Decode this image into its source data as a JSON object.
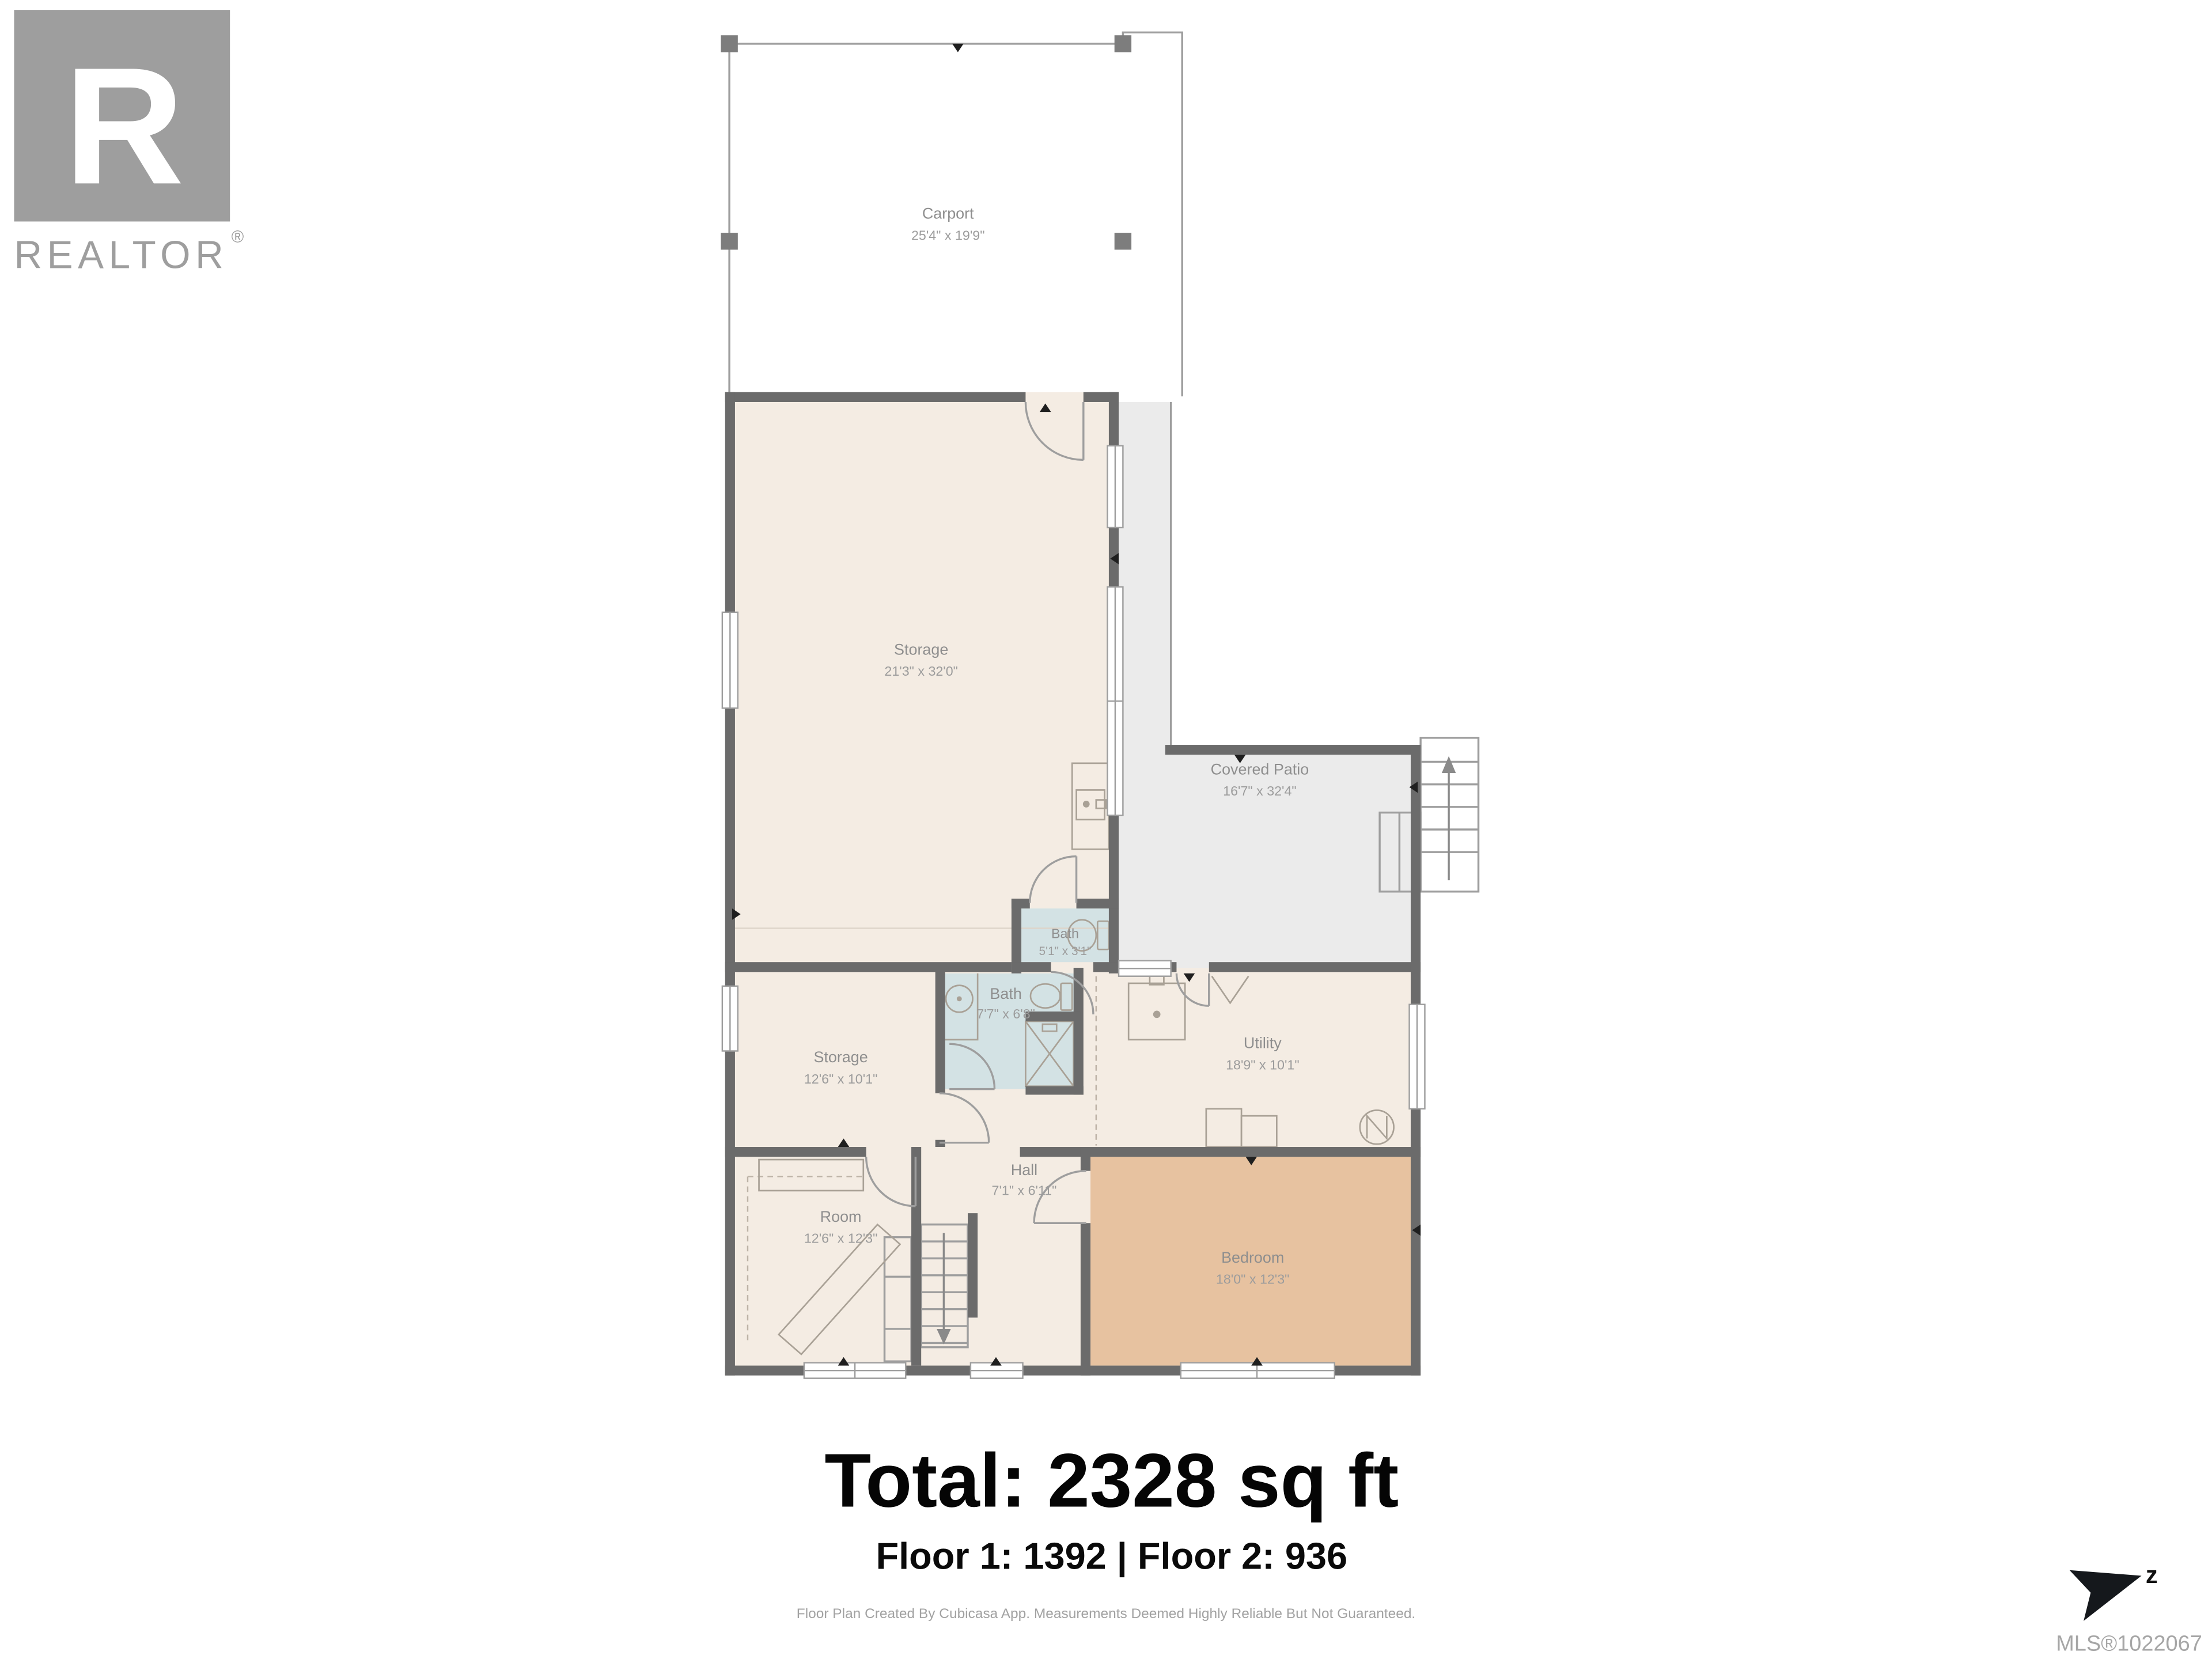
{
  "branding": {
    "logo_letter": "R",
    "logo_text": "REALTOR",
    "registered_mark": "®"
  },
  "rooms": [
    {
      "name": "Carport",
      "dims": "25'4\" x 19'9\""
    },
    {
      "name": "Storage",
      "dims": "21'3\" x 32'0\""
    },
    {
      "name": "Covered Patio",
      "dims": "16'7\" x 32'4\""
    },
    {
      "name": "Bath",
      "dims": "5'1\" x 3'1\""
    },
    {
      "name": "Bath",
      "dims": "7'7\" x 6'8\""
    },
    {
      "name": "Storage",
      "dims": "12'6\" x 10'1\""
    },
    {
      "name": "Utility",
      "dims": "18'9\" x 10'1\""
    },
    {
      "name": "Hall",
      "dims": "7'1\" x 6'11\""
    },
    {
      "name": "Room",
      "dims": "12'6\" x 12'3\""
    },
    {
      "name": "Bedroom",
      "dims": "18'0\" x 12'3\""
    }
  ],
  "summary": {
    "total": "Total: 2328 sq ft",
    "floors": "Floor 1: 1392 | Floor 2: 936"
  },
  "footer": {
    "disclaimer": "Floor Plan Created By Cubicasa App. Measurements Deemed Highly Reliable But Not Guaranteed.",
    "mls": "MLS®1022067"
  },
  "compass": {
    "label": "z"
  },
  "colors": {
    "wall": "#6b6b6b",
    "room_fill": "#f4ece3",
    "bath_fill": "#d3e2e4",
    "bedroom_fill": "#e7c2a0",
    "patio_fill": "#ebebeb",
    "outline": "#9e9e9e",
    "label_text": "#8e8e8e",
    "logo_gray": "#9e9e9e",
    "total_text": "#050505"
  }
}
